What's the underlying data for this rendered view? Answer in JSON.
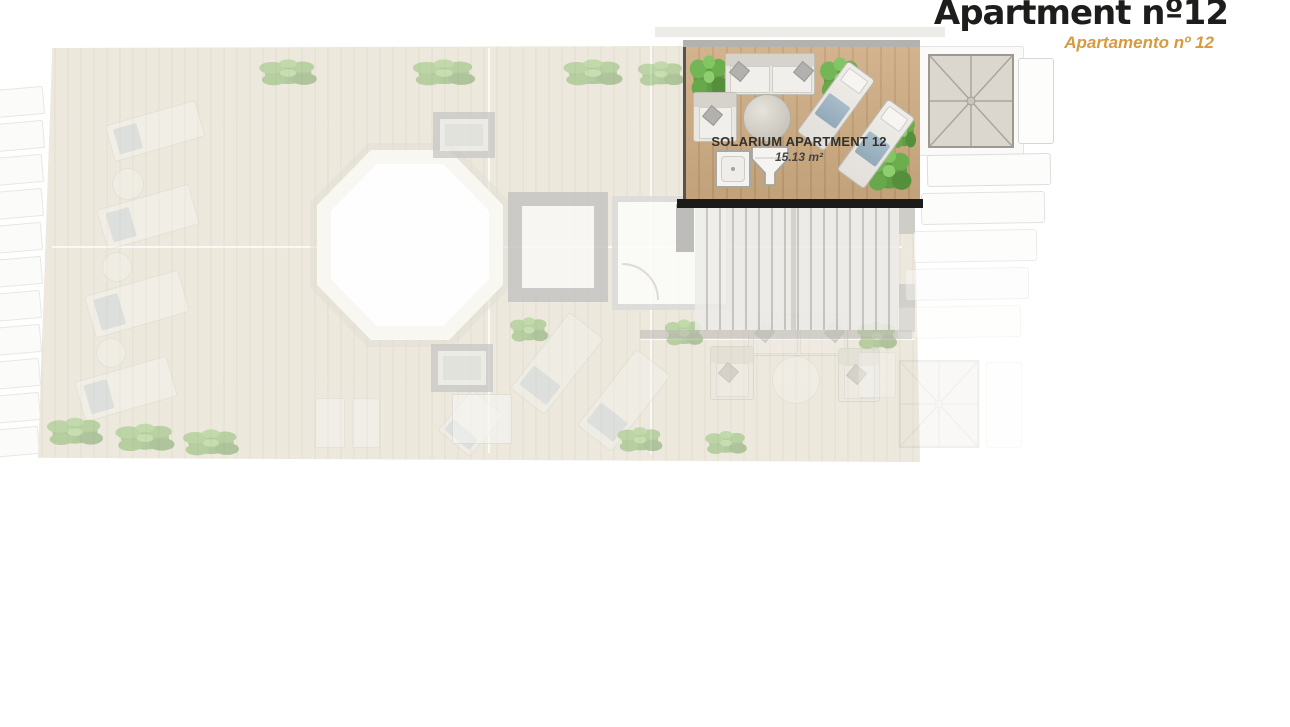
{
  "header": {
    "title": "Apartment nº12",
    "subtitle": "Apartamento nº 12"
  },
  "solarium": {
    "label": "SOLARIUM APARTMENT 12",
    "area": "15.13 m²"
  },
  "colors": {
    "accent": "#d79a3f",
    "wall": "#1b1b1a",
    "wood": "#cdab81",
    "deck": "#f1eee5",
    "structure-gray": "#c7c7c5"
  },
  "icons": {
    "plant-icon": "css-green-circle-cluster",
    "sun-lounger-icon": "css-rect-with-blue-towel",
    "sofa-icon": "css-rect-with-cushions",
    "armchair-icon": "css-rect-with-pillow",
    "round-table-icon": "css-circle",
    "pool-icon": "css-white-octagon",
    "hip-roof-icon": "svg-radial-ridge-lines",
    "stairs-icon": "css-vertical-stripes",
    "shower-tray-icon": "css-square-with-drain",
    "sink-hopper-icon": "svg-tapered-polygon",
    "skylight-icon": "css-gray-frame-square"
  }
}
